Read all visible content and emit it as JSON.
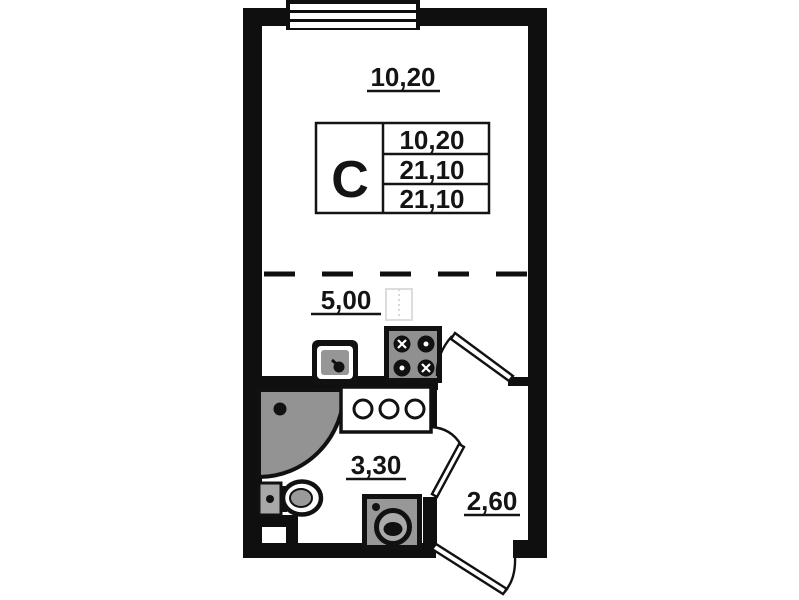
{
  "plan": {
    "unit_letter": "C",
    "areas": {
      "living_room": "10,20",
      "kitchen": "5,00",
      "bathroom": "3,30",
      "hallway": "2,60"
    },
    "info_table": {
      "unit_type": "C",
      "rows": [
        "10,20",
        "21,10",
        "21,10"
      ]
    },
    "fixtures": [
      "window",
      "stove",
      "kitchen-sink",
      "corner-shower",
      "toilet",
      "washing-machine",
      "vanity-counter",
      "door"
    ],
    "colors": {
      "wall": "#0f0f0f",
      "fixture_gray": "#939393",
      "background": "#ffffff"
    }
  }
}
